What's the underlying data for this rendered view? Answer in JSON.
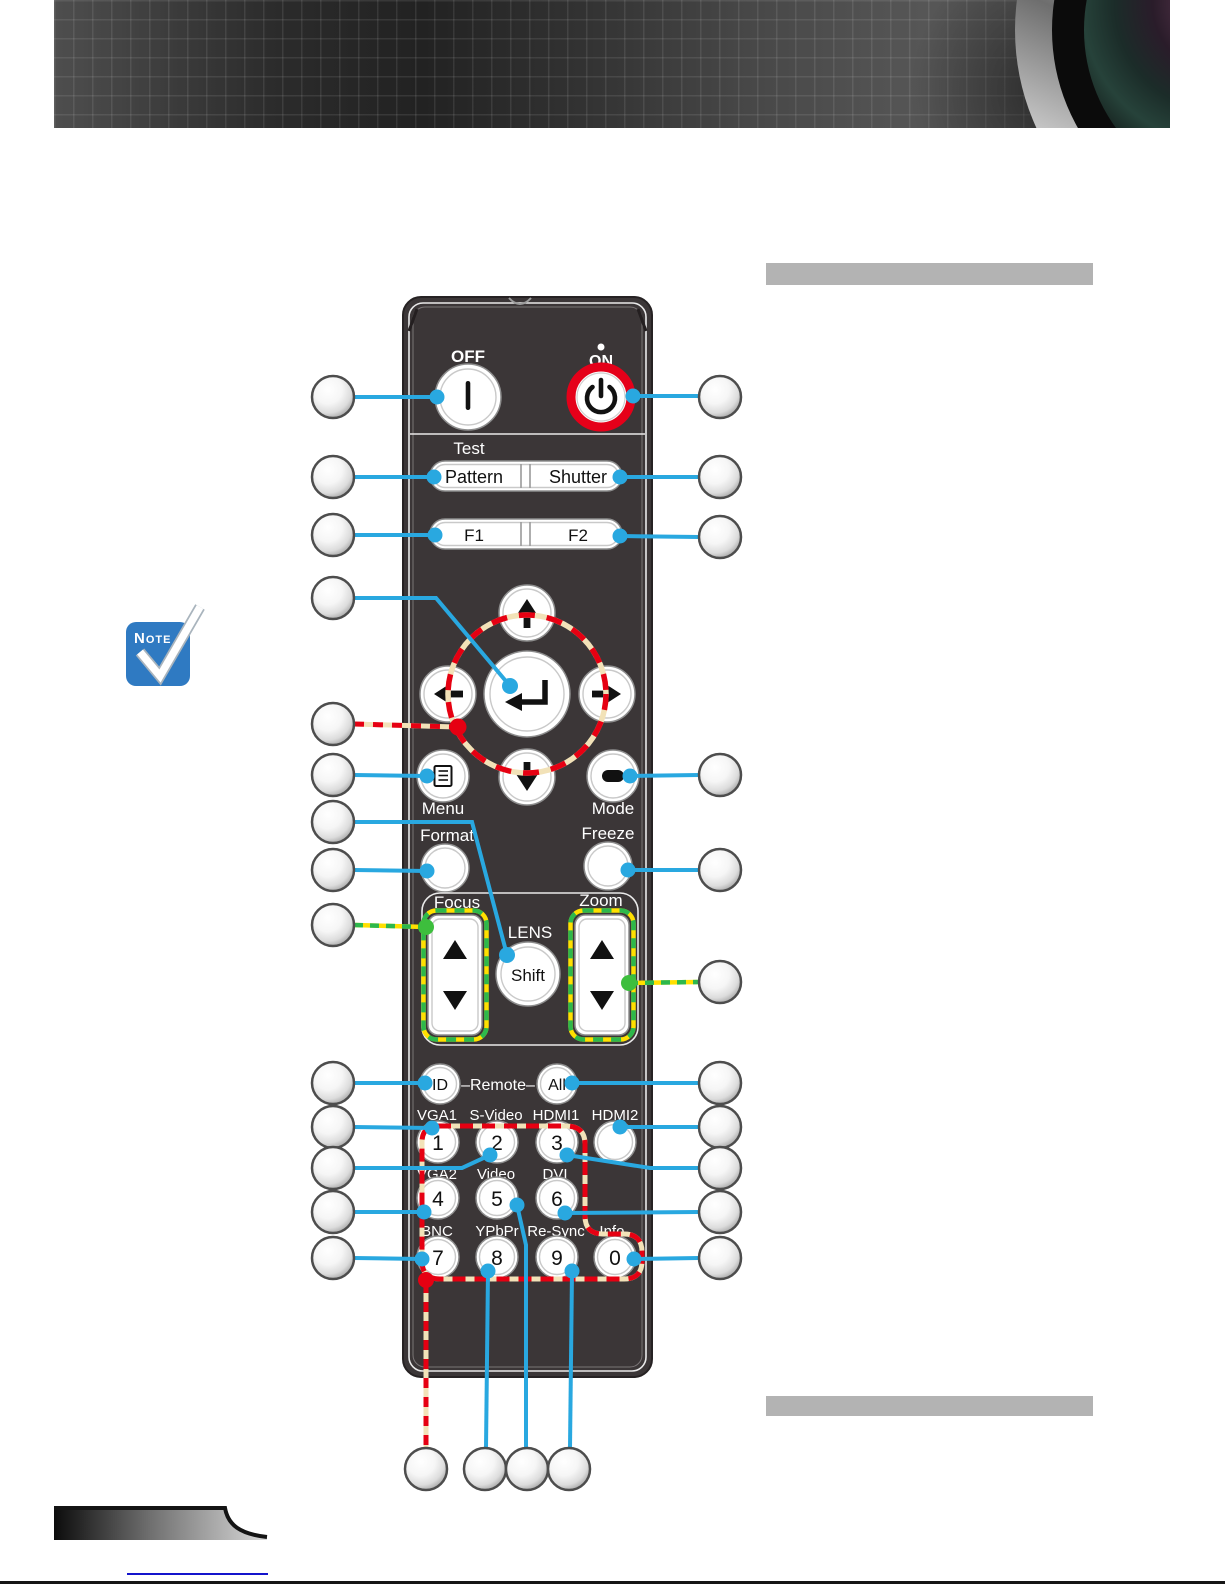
{
  "note": {
    "label": "Note"
  },
  "remote": {
    "off_label": "OFF",
    "on_label": "ON",
    "test_label": "Test",
    "pattern_label": "Pattern",
    "shutter_label": "Shutter",
    "f1_label": "F1",
    "f2_label": "F2",
    "menu_label": "Menu",
    "mode_label": "Mode",
    "format_label": "Format",
    "freeze_label": "Freeze",
    "focus_label": "Focus",
    "zoom_label": "Zoom",
    "lens_label": "LENS",
    "shift_label": "Shift",
    "id_label": "ID",
    "remote_group_label": "–Remote–",
    "all_label": "All",
    "sources": {
      "vga1": "VGA1",
      "s_video": "S-Video",
      "hdmi1": "HDMI1",
      "hdmi2": "HDMI2",
      "vga2": "VGA2",
      "video": "Video",
      "dvi": "DVI",
      "bnc": "BNC",
      "ypbpr": "YPbPr",
      "re_sync": "Re-Sync",
      "info": "Info."
    },
    "digits": {
      "d1": "1",
      "d2": "2",
      "d3": "3",
      "d4": "4",
      "d5": "5",
      "d6": "6",
      "d7": "7",
      "d8": "8",
      "d9": "9",
      "d0": "0"
    }
  },
  "colors": {
    "callout_line_blue": "#29A8E0",
    "highlight_red": "#E60012",
    "highlight_cream": "#F2E2B8",
    "highlight_green": "#2DB84C",
    "highlight_yellow": "#FFE000",
    "power_ring_red": "#E50019",
    "note_blue": "#2F7AC2",
    "placeholder_bar_gray": "#B3B3B3",
    "remote_body": "#3B3637"
  }
}
